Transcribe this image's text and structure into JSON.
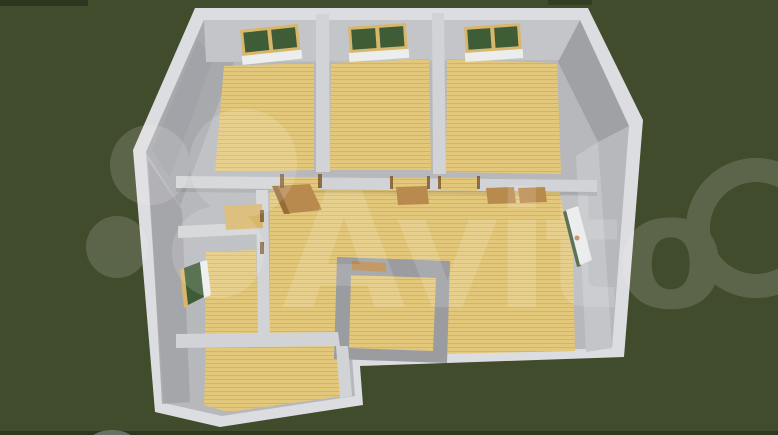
{
  "scene": {
    "title": "3D top-down render of a single-storey house floor plan on a green lawn",
    "watermark": {
      "text": "Avito",
      "color": "#ffffff",
      "opacity": 0.14
    },
    "colors": {
      "grass": "#414c2c",
      "wall_top": "#dcdde0",
      "wall_face": "#c4c5c9",
      "wall_face_dark": "#a0a1a5",
      "wall_chamfer": "#a8a9ad",
      "inner_base": "#b7b8bc",
      "wall_band": "#d2d3d6",
      "room_divider": "#9b9ca0",
      "floor": "#e3c87c",
      "floor_line": "#c9a75c",
      "glass": "#3e5c36",
      "frame": "#d8b66a",
      "sill": "#eceded",
      "door": "#b98a4e",
      "door_dark": "#7a5528",
      "door_white": "#e9eaec",
      "stone": "#6c6f66"
    },
    "features": {
      "top_wall_windows": 3,
      "left_wall_windows": 1,
      "open_interior_doors": 4,
      "open_exterior_door_right_wall": 1,
      "wood_floored_rooms": 7
    }
  }
}
